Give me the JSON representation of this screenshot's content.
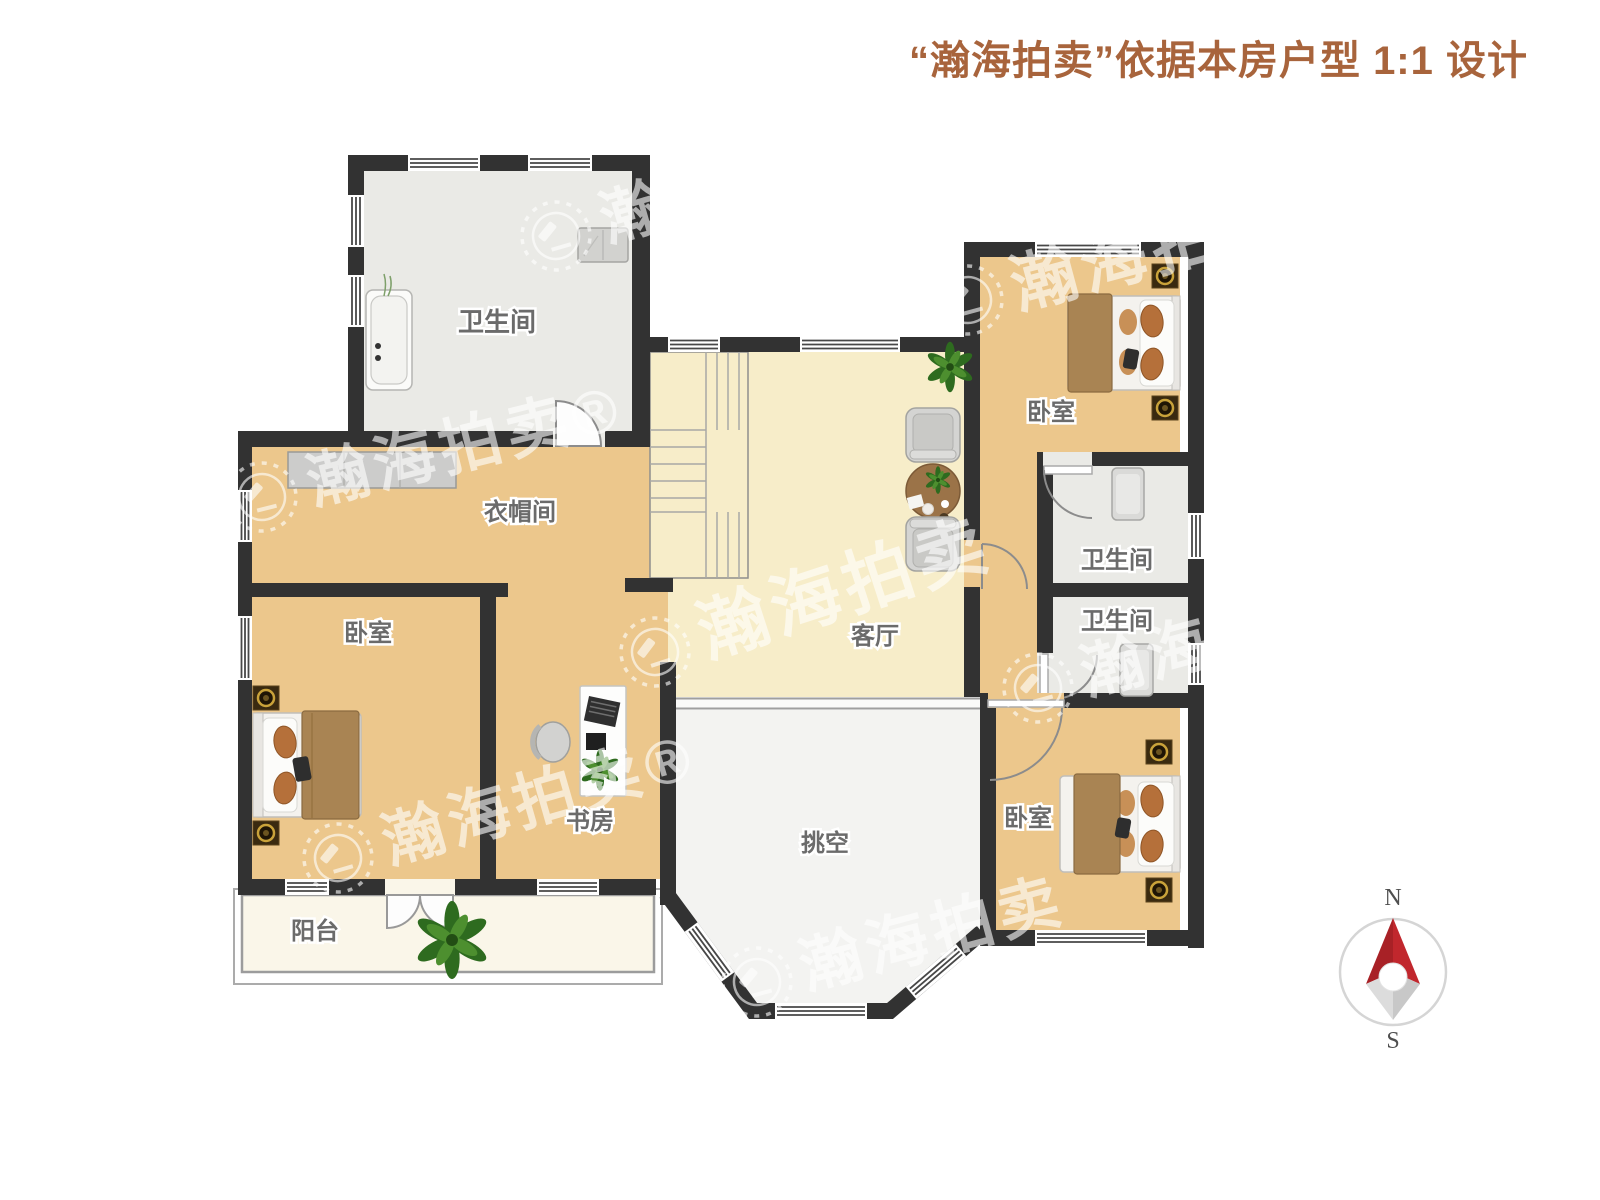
{
  "header": {
    "title": "“瀚海拍卖”依据本房户型 1:1 设计"
  },
  "watermark": {
    "brand": "瀚海拍卖",
    "brand_registered": "瀚海拍卖®"
  },
  "rooms": {
    "bathroom_top_left": "卫生间",
    "cloakroom": "衣帽间",
    "bedroom_left": "卧室",
    "study": "书房",
    "balcony": "阳台",
    "living_room": "客厅",
    "void_space": "挑空",
    "bedroom_top_right": "卧室",
    "bathroom_upper_right": "卫生间",
    "bathroom_lower_right": "卫生间",
    "bedroom_bottom_right": "卧室"
  },
  "compass": {
    "north_label": "N",
    "south_label": "S"
  },
  "colors": {
    "accent_header": "#a8643c",
    "wall": "#323232",
    "wood_floor": "#ecc78c",
    "living_floor": "#f7edc9",
    "bath_floor": "#eaeae6",
    "void_floor": "#f3f3f1",
    "balcony_floor": "#faf6e9",
    "compass_red": "#c1272d",
    "label_text": "#6b6b6b"
  }
}
